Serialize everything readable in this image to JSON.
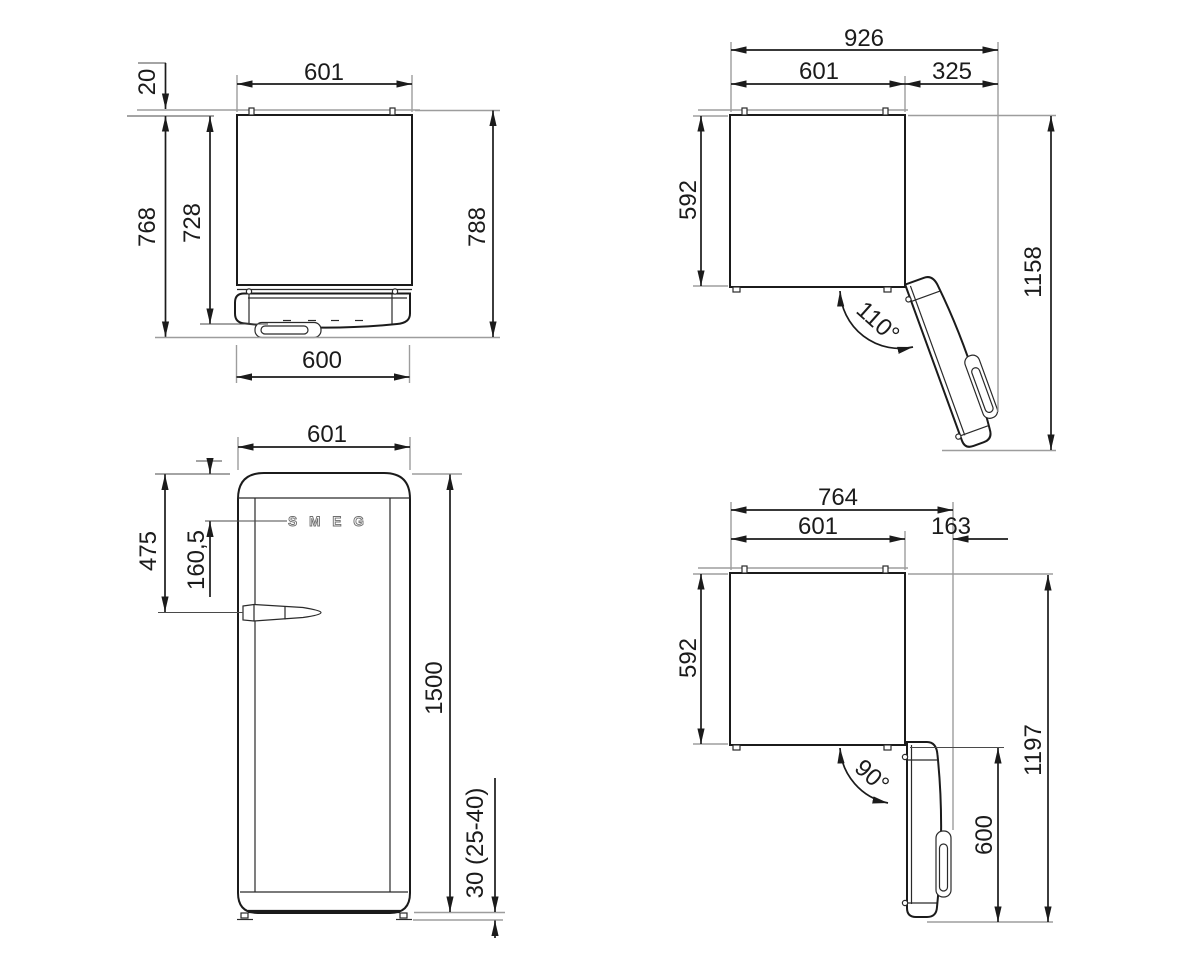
{
  "drawing_title": "refrigerator-dimension-drawing",
  "v1": {
    "view": "top-view-door-closed",
    "w_top": "601",
    "gap": "20",
    "d_body": "728",
    "d_door": "768",
    "d_total": "788",
    "w_door": "600"
  },
  "v2": {
    "view": "top-view-door-open-110",
    "w_total": "926",
    "w_body": "601",
    "w_open": "325",
    "depth": "592",
    "d_total": "1158",
    "angle": "110°"
  },
  "v3": {
    "view": "front-view",
    "width": "601",
    "handle_from_top": "475",
    "logo_from_top": "160,5",
    "height": "1500",
    "feet": "30 (25-40)",
    "logo": "SMEG"
  },
  "v4": {
    "view": "top-view-door-open-90",
    "w_total": "764",
    "w_body": "601",
    "w_handle": "163",
    "depth": "592",
    "d_total": "1197",
    "d_door": "600",
    "angle": "90°"
  }
}
